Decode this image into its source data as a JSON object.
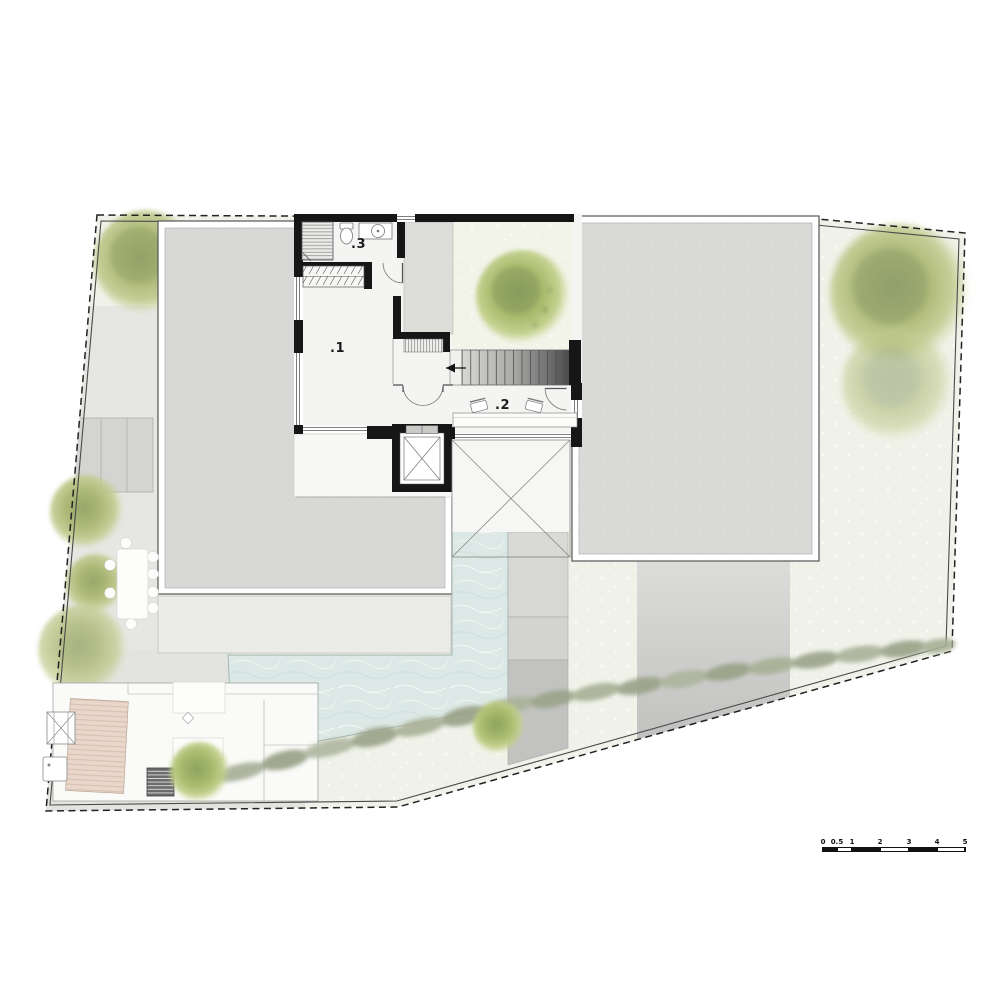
{
  "plan": {
    "room_labels": [
      {
        "id": "room-1",
        "label": ".1"
      },
      {
        "id": "room-2",
        "label": ".2"
      },
      {
        "id": "room-3",
        "label": ".3"
      }
    ]
  },
  "scale_bar": {
    "unit_labels": [
      "0",
      "0.5",
      "1",
      "2",
      "3",
      "4",
      "5"
    ]
  },
  "palette": {
    "grass": "#f0f2e9",
    "paving": "#e6e7e3",
    "roof_gray": "#d8d9d6",
    "water": "#dce8e5",
    "deck_wood": "#e9d7cb",
    "tree_green": "#b2bd7c",
    "wall_black": "#161616",
    "hedge_green": "#a3ab93"
  }
}
